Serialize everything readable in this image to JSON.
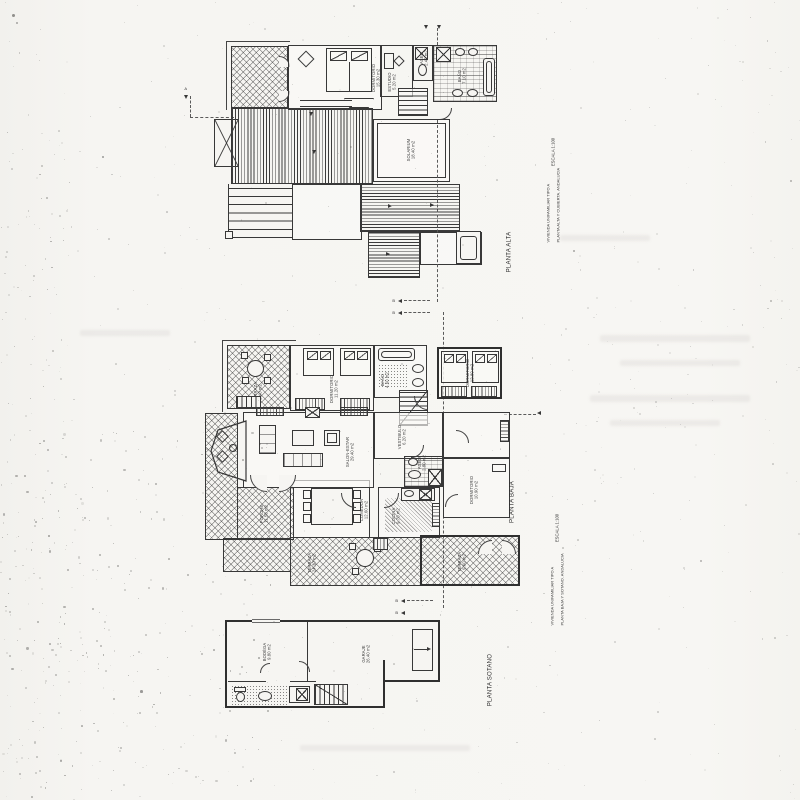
{
  "sheet": {
    "plan_labels": {
      "alta": "PLANTA ALTA",
      "baja": "PLANTA BAJA",
      "sotano": "PLANTA SOTANO"
    },
    "titleblock_top": {
      "line1": "VIVIENDA UNIFAMILIAR TIPO A",
      "line2": "PLANTA ALTA Y CUBIERTA. ANDALUCIA",
      "scale": "ESCALA 1:100"
    },
    "titleblock_bottom": {
      "line1": "VIVIENDA UNIFAMILIAR TIPO A",
      "line2": "PLANTA BAJA Y SOTANO. ANDALUCIA",
      "scale": "ESCALA 1:100"
    },
    "section_markers": {
      "a": "A",
      "b": "B"
    }
  },
  "rooms": {
    "alta": {
      "terraza": "TERRAZA\n9.20 m2",
      "dormitorio": "DORMITORIO\n15.30 m2",
      "estudio": "ESTUDIO\n5.20 m2",
      "aseo": "ASEO\n2.40 m2",
      "bano": "BAÑO\n7.10 m2",
      "solarium": "SOLARIUM\n18.40 m2"
    },
    "baja": {
      "terraza1": "TERRAZA\n8.40 m2",
      "dorm1": "DORMITORIO\n11.20 m2",
      "bano": "BAÑO\n4.60 m2",
      "dorm2": "DORMITORIO\n12.80 m2",
      "salon": "SALON-ESTAR\n29.40 m2",
      "vestibulo": "VESTIBULO\n6.20 m2",
      "comedor": "COMEDOR\n12.60 m2",
      "cocina": "COCINA\n9.70 m2",
      "aseo": "ASEO\n2.80 m2",
      "dorm3": "DORMITORIO\n10.90 m2",
      "porche": "PORCHE\n11.50 m2",
      "terraza2": "TERRAZA\n24.30 m2",
      "terraza3": "TERRAZA\n9.60 m2"
    },
    "sotano": {
      "bodega": "BODEGA\n9.80 m2",
      "garaje": "GARAJE\n26.40 m2"
    }
  },
  "colors": {
    "ink": "#383838",
    "paper": "#f6f5f2",
    "label": "#3d3d3d"
  }
}
